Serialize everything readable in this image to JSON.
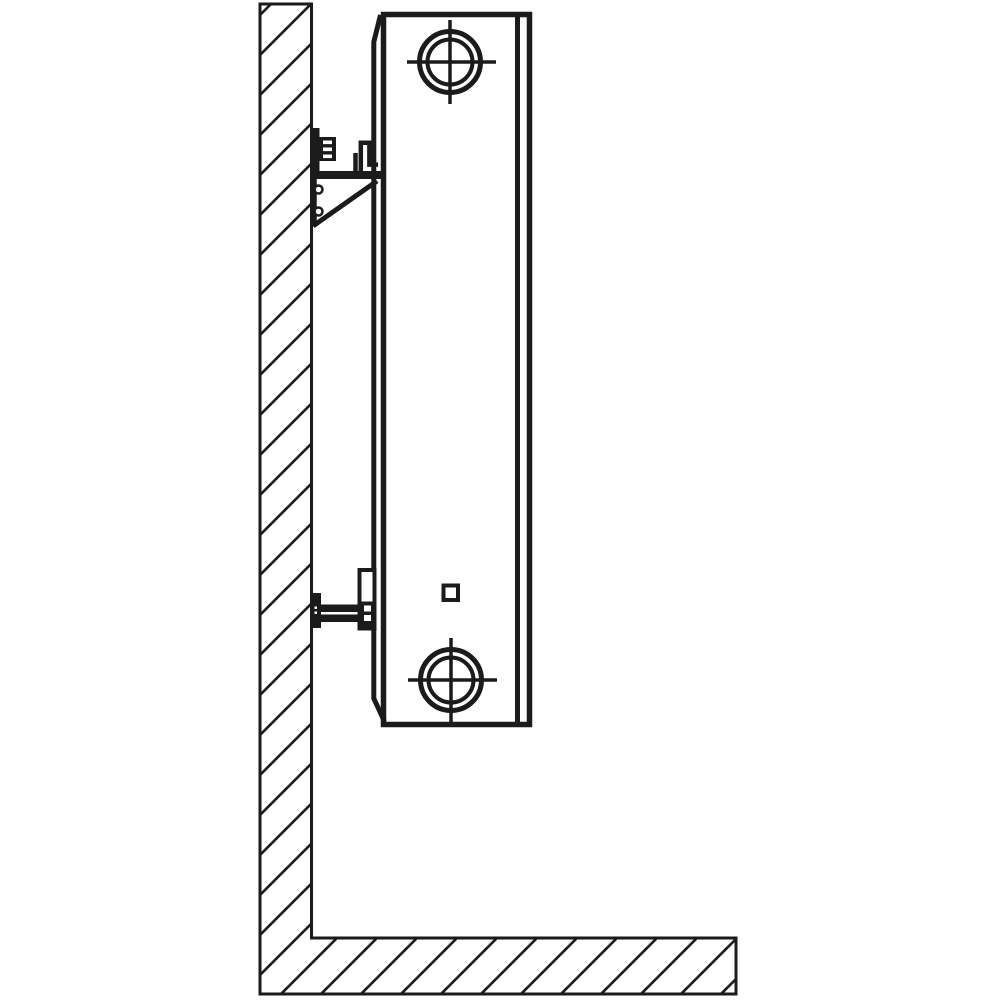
{
  "canvas": {
    "width": 1000,
    "height": 1000,
    "background": "#ffffff"
  },
  "drawing": {
    "type": "technical-line-drawing",
    "subject": "side view of a wall-mounted panel radiator with upper and lower mounting brackets",
    "line_color": "#1b1b1b",
    "white": "#ffffff",
    "hatch": {
      "pattern": "diagonal-45deg",
      "spacing_px": 40,
      "stroke_px": 2.6
    },
    "components": [
      "hatched wall section",
      "hatched floor section",
      "radiator side profile",
      "radiator back panel with beveled ends",
      "top pipe connection boss with center-line crosshair",
      "bottom pipe connection boss with center-line crosshair",
      "small square detail near bottom",
      "upper wall bracket: anchor bar, adjustment clip, hanging hook, support gusset with two bumps and diagonal strut",
      "lower wall bracket: anchor bar, double-bar rod, clamp plate with two square holes"
    ]
  }
}
